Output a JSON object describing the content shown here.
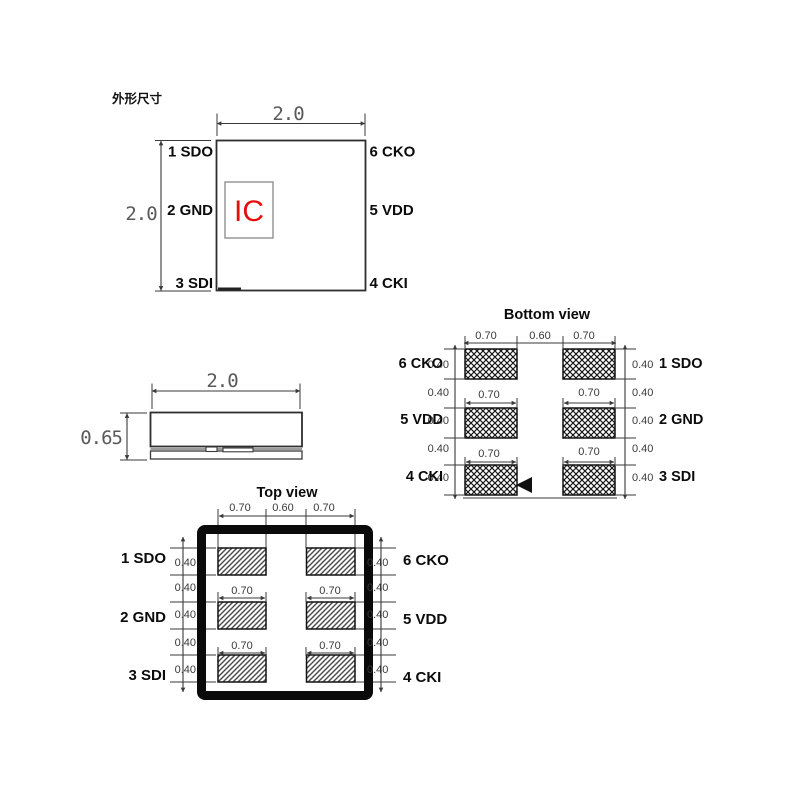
{
  "page_title": "外形尺寸",
  "colors": {
    "accent_red": "#e80d0d",
    "line_gray": "#3a3a3a",
    "text_dark": "#0b0b0b",
    "background": "#ffffff"
  },
  "outline_view": {
    "width_dim": "2.0",
    "height_dim": "2.0",
    "ic_label": "IC",
    "pins_left": [
      "1 SDO",
      "2 GND",
      "3 SDI"
    ],
    "pins_right": [
      "6 CKO",
      "5 VDD",
      "4 CKI"
    ]
  },
  "side_view": {
    "width_dim": "2.0",
    "height_dim": "0.65"
  },
  "bottom_view": {
    "title": "Bottom view",
    "top_dims": [
      "0.70",
      "0.60",
      "0.70"
    ],
    "row_dims": [
      "0.70",
      "0.70",
      "0.70",
      "0.70"
    ],
    "left_dims": [
      "0.40",
      "0.40",
      "0.40",
      "0.40",
      "0.40"
    ],
    "right_dims": [
      "0.40",
      "0.40",
      "0.40",
      "0.40",
      "0.40"
    ],
    "pins_left": [
      "6 CKO",
      "5 VDD",
      "4 CKI"
    ],
    "pins_right": [
      "1 SDO",
      "2 GND",
      "3 SDI"
    ]
  },
  "top_view": {
    "title": "Top view",
    "top_dims": [
      "0.70",
      "0.60",
      "0.70"
    ],
    "row_dims": [
      "0.70",
      "0.70",
      "0.70",
      "0.70"
    ],
    "left_dims": [
      "0.40",
      "0.40",
      "0.40",
      "0.40",
      "0.40"
    ],
    "right_dims": [
      "0.40",
      "0.40",
      "0.40",
      "0.40",
      "0.40"
    ],
    "pins_left": [
      "1 SDO",
      "2 GND",
      "3 SDI"
    ],
    "pins_right": [
      "6 CKO",
      "5 VDD",
      "4 CKI"
    ]
  }
}
